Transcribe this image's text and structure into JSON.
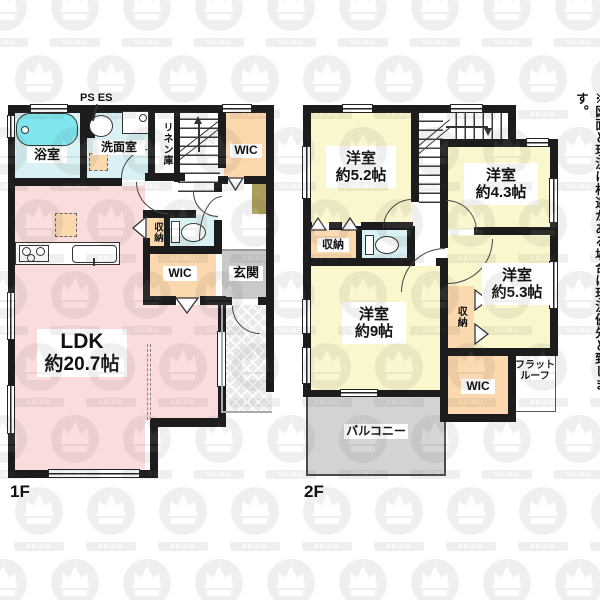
{
  "note": "※図面と現況に相違がある場合は現況優先と致します。",
  "watermark": {
    "text": "SEIBU"
  },
  "colors": {
    "wall": "#1c1c1c",
    "pink": "#f9dcdb",
    "yellow": "#faf6cd",
    "peach": "#fbd8ad",
    "cyanLight": "#d9f1f4",
    "tub": "#7fe6ee",
    "gray": "#c9c9c9",
    "balcony": "#d3d3d3",
    "olive": "#ab9e5a"
  },
  "floor1": {
    "label": "1F",
    "ps": "PS ES",
    "bath": "浴室",
    "washroom": "洗面室",
    "linen": "リネン庫",
    "wic_top": "WIC",
    "storage": "収納",
    "wic_mid": "WIC",
    "entrance": "玄関",
    "ldk_name": "LDK",
    "ldk_area": "約20.7帖"
  },
  "floor2": {
    "label": "2F",
    "bed52_name": "洋室",
    "bed52_area": "約5.2帖",
    "bed43_name": "洋室",
    "bed43_area": "約4.3帖",
    "bed53_name": "洋室",
    "bed53_area": "約5.3帖",
    "bed9_name": "洋室",
    "bed9_area": "約9帖",
    "closet_left": "収納",
    "closet_right": "収納",
    "wic": "WIC",
    "balcony": "バルコニー",
    "flatroof_line1": "フラット",
    "flatroof_line2": "ルーフ"
  }
}
